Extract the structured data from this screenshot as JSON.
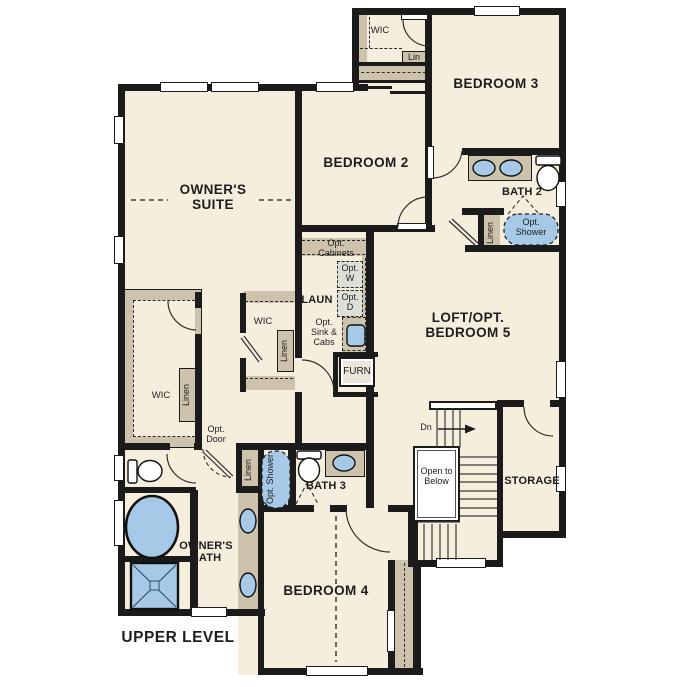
{
  "plan_title": "UPPER LEVEL",
  "colors": {
    "floor": "#f6eedd",
    "closet": "#cdc2ab",
    "wall": "#1b1b1b",
    "fixture": "#a6c9e7",
    "appliance": "#dcdfd6"
  },
  "rooms": {
    "owners_suite": "OWNER'S SUITE",
    "owners_bath": "OWNER'S BATH",
    "bedroom2": "BEDROOM 2",
    "bedroom3": "BEDROOM 3",
    "bedroom4": "BEDROOM 4",
    "loft": "LOFT/OPT. BEDROOM 5",
    "bath2": "BATH 2",
    "bath3": "BATH 3",
    "laundry": "LAUN",
    "storage": "STORAGE",
    "wic_top": "WIC",
    "wic_left": "WIC",
    "wic_mid": "WIC",
    "lin": "Lin",
    "linen_bath2": "Linen",
    "linen_left": "Linen",
    "linen_mid": "Linen",
    "linen_bath3": "Linen",
    "opt_shower_bath2": "Opt. Shower",
    "opt_shower_bath3": "Opt. Shower",
    "opt_cabinets": "Opt. Cabinets",
    "opt_w": "Opt. W",
    "opt_d": "Opt. D",
    "opt_sink_cabs": "Opt. Sink & Cabs",
    "opt_door": "Opt. Door",
    "furn": "FURN",
    "stairs_dn": "Dn",
    "open_to_below": "Open to Below"
  }
}
